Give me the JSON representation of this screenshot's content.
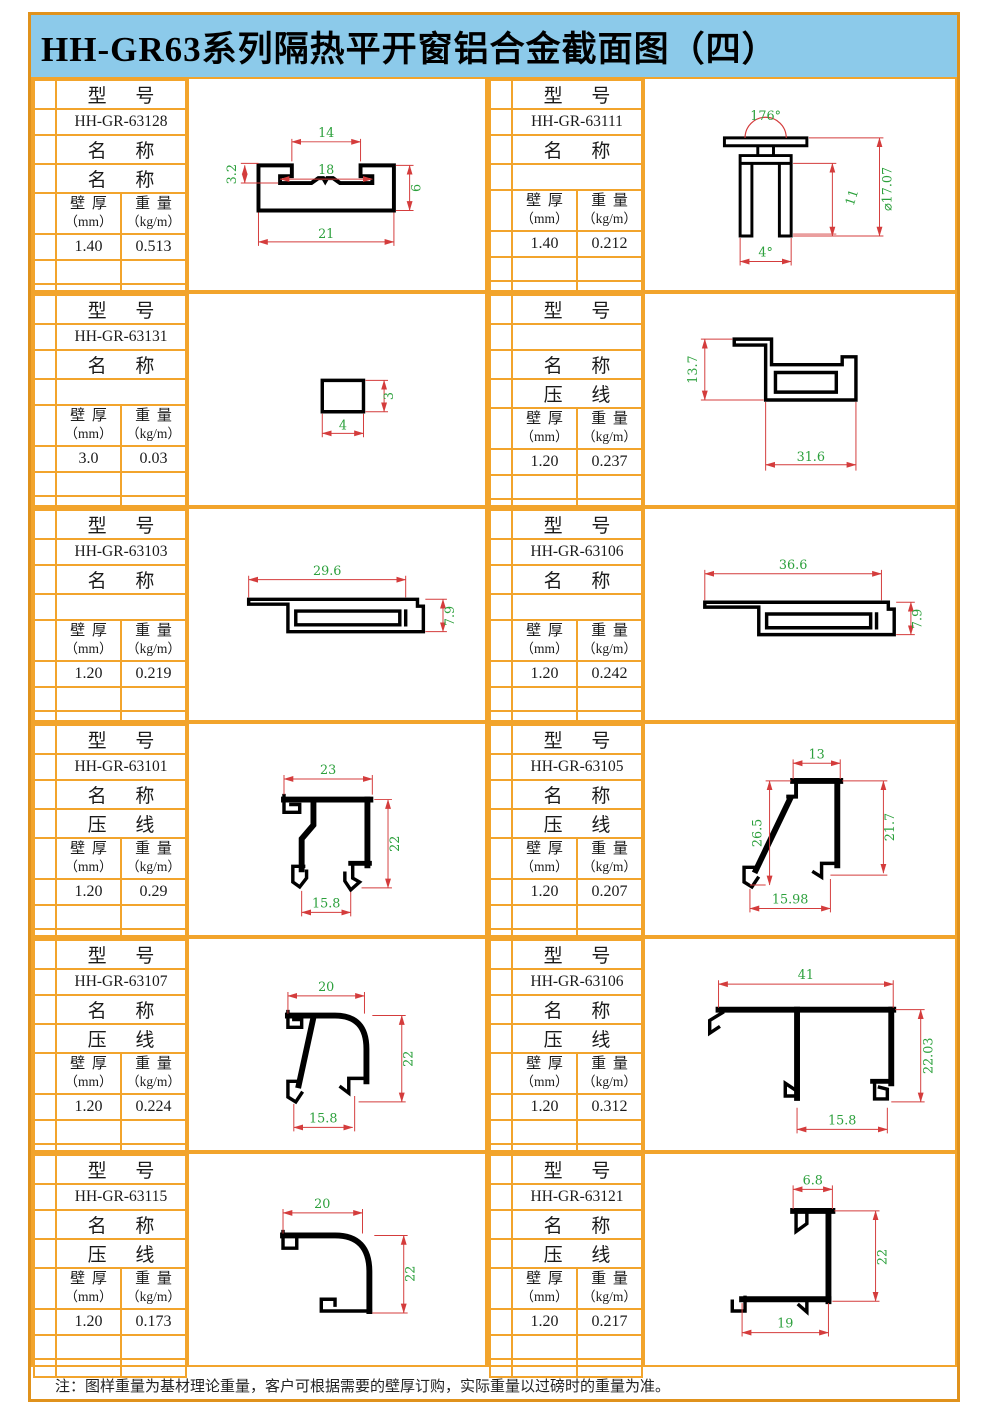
{
  "title": "HH-GR63系列隔热平开窗铝合金截面图（四）",
  "footer_note": "注：图样重量为基材理论重量，客户可根据需要的壁厚订购，实际重量以过磅时的重量为准。",
  "labels": {
    "model": "型 号",
    "name": "名 称",
    "thickness": "壁 厚",
    "thickness_unit": "（mm）",
    "weight": "重 量",
    "weight_unit": "（kg/m）"
  },
  "colors": {
    "frame_orange": "#e0921c",
    "grid_orange": "#f2a42c",
    "title_bg": "#8ccaea",
    "dimension_line_red": "#d43c3c",
    "dimension_text_green": "#2ca03c",
    "profile_black": "#000000"
  },
  "blocks": [
    {
      "model": "HH-GR-63128",
      "name_value": "名 称",
      "thickness": "1.40",
      "weight": "0.513",
      "dims": [
        "14",
        "18",
        "3.2",
        "6",
        "21"
      ]
    },
    {
      "model": "HH-GR-63111",
      "name_value": "",
      "thickness": "1.40",
      "weight": "0.212",
      "dims": [
        "176°",
        "⌀17.07",
        "11",
        "4°"
      ]
    },
    {
      "model": "HH-GR-63131",
      "name_value": "",
      "thickness": "3.0",
      "weight": "0.03",
      "dims": [
        "4",
        "3"
      ]
    },
    {
      "model": "",
      "name_value": "压 线",
      "thickness": "1.20",
      "weight": "0.237",
      "dims": [
        "13.7",
        "31.6"
      ]
    },
    {
      "model": "HH-GR-63103",
      "name_value": "",
      "thickness": "1.20",
      "weight": "0.219",
      "dims": [
        "29.6",
        "7.9"
      ]
    },
    {
      "model": "HH-GR-63106",
      "name_value": "",
      "thickness": "1.20",
      "weight": "0.242",
      "dims": [
        "36.6",
        "7.9"
      ]
    },
    {
      "model": "HH-GR-63101",
      "name_value": "压 线",
      "thickness": "1.20",
      "weight": "0.29",
      "dims": [
        "23",
        "22",
        "15.8"
      ]
    },
    {
      "model": "HH-GR-63105",
      "name_value": "压 线",
      "thickness": "1.20",
      "weight": "0.207",
      "dims": [
        "13",
        "26.5",
        "21.7",
        "15.98"
      ]
    },
    {
      "model": "HH-GR-63107",
      "name_value": "压 线",
      "thickness": "1.20",
      "weight": "0.224",
      "dims": [
        "20",
        "22",
        "15.8"
      ]
    },
    {
      "model": "HH-GR-63106",
      "name_value": "压 线",
      "thickness": "1.20",
      "weight": "0.312",
      "dims": [
        "41",
        "22.03",
        "15.8"
      ]
    },
    {
      "model": "HH-GR-63115",
      "name_value": "压 线",
      "thickness": "1.20",
      "weight": "0.173",
      "dims": [
        "20",
        "22"
      ]
    },
    {
      "model": "HH-GR-63121",
      "name_value": "压 线",
      "thickness": "1.20",
      "weight": "0.217",
      "dims": [
        "6.8",
        "22",
        "19"
      ]
    }
  ]
}
